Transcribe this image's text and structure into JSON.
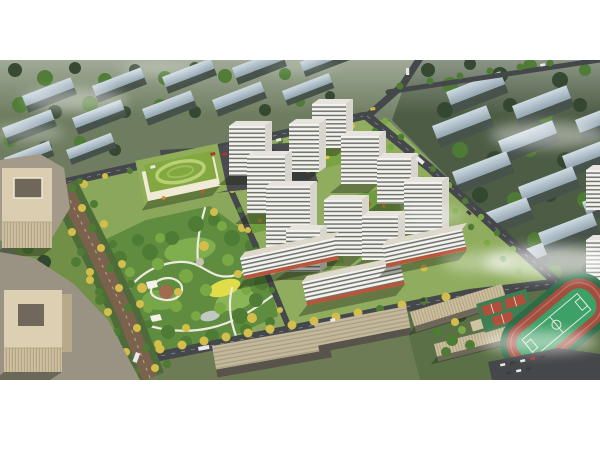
{
  "scene": {
    "type": "aerial-architectural-rendering",
    "description": "Bird's-eye photorealistic rendering of a residential masterplan: white high-rise towers around green courtyards, a large central park with winding paths and a yellow meadow, a tree-lined boulevard, kindergarten with green roof, beige office buildings, retail street slabs, a school campus with running track and basketball courts, parking lots, surrounding muted context housing blocks and drifting fog, on a white page with top and bottom margins",
    "elements": [
      "context-housing-blocks",
      "residential-towers",
      "central-park",
      "tree-lined-boulevard",
      "kindergarten",
      "office-buildings",
      "retail-street-slabs",
      "school-campus",
      "sports-field",
      "basketball-courts",
      "parking-lots",
      "roads",
      "street-trees",
      "fog-clouds"
    ]
  },
  "canvas": {
    "width": 600,
    "height": 450,
    "render_top": 60,
    "render_bottom": 380,
    "background": "#ffffff"
  },
  "palette": {
    "page_bg": "#ffffff",
    "ctx_left_ground": "#6e7d60",
    "ctx_right_ground": "#4d5c45",
    "ctx_far_ground": "#5b7047",
    "ctx_south_ground": "#6d7c55",
    "ctx_roof_light": "#cfdbe3",
    "ctx_roof_dark": "#93a5b1",
    "ctx_face": "#46524a",
    "tree_dark": "#33462f",
    "tree_green": "#4e7c34",
    "tree_light": "#79a845",
    "tree_yellow": "#d3be4c",
    "site_lawn": "#8aa75b",
    "cluster_lawn": "#90ad5f",
    "park_green": "#5f8c3e",
    "meadow_yellow": "#e0dc4a",
    "path_white": "#edeadf",
    "plaza_brown": "#a06b4e",
    "road_dark": "#45484b",
    "boulevard_brown": "#7b624c",
    "tower_white": "#f3f2ee",
    "tower_stripe": "#6f746b",
    "tower_side": "#d7d5cd",
    "tower_roof": "#e6e4dc",
    "retail_red": "#b5573c",
    "slab_tan": "#c3b89c",
    "beige_building": "#dacdb0",
    "beige_ribs": "#b7aa8a",
    "plaza_gray": "#a09888",
    "field_green": "#3da066",
    "track_red": "#a34f40",
    "court_red": "#b0503c",
    "parking_gray": "#4a4b4e",
    "kindergarten_roof": "#82a83f",
    "fog_white": "#ffffff"
  }
}
